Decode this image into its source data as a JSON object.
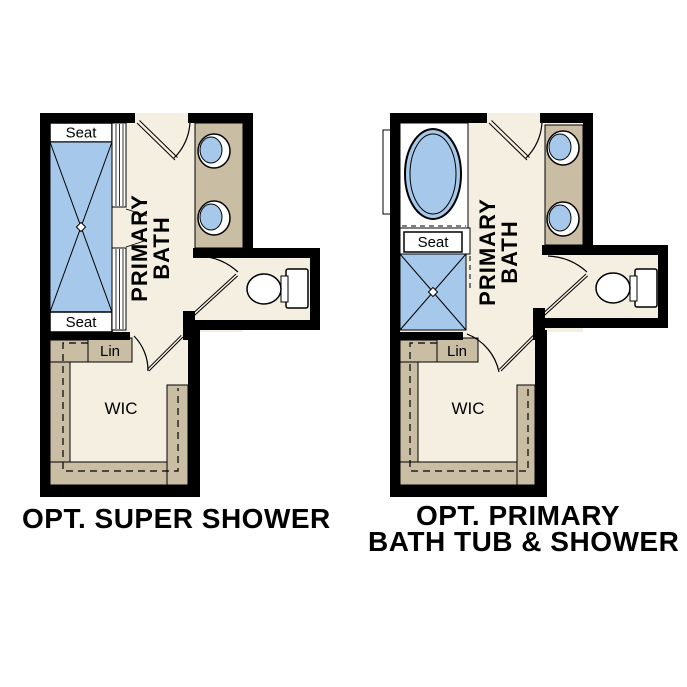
{
  "colors": {
    "wall": "#000000",
    "floor_cream": "#f5efe2",
    "fixture_blue": "#a6c8ea",
    "cabinet_tan": "#c9bda3",
    "fixture_white": "#ffffff",
    "text": "#000000"
  },
  "plans": [
    {
      "id": "super-shower",
      "title": "OPT. SUPER SHOWER",
      "bath_label_line1": "PRIMARY",
      "bath_label_line2": "BATH",
      "seat_top_label": "Seat",
      "seat_bottom_label": "Seat",
      "linen_label": "Lin",
      "wic_label": "WIC"
    },
    {
      "id": "tub-shower",
      "title_line1": "OPT. PRIMARY",
      "title_line2": "BATH TUB & SHOWER",
      "bath_label_line1": "PRIMARY",
      "bath_label_line2": "BATH",
      "seat_label": "Seat",
      "linen_label": "Lin",
      "wic_label": "WIC"
    }
  ]
}
